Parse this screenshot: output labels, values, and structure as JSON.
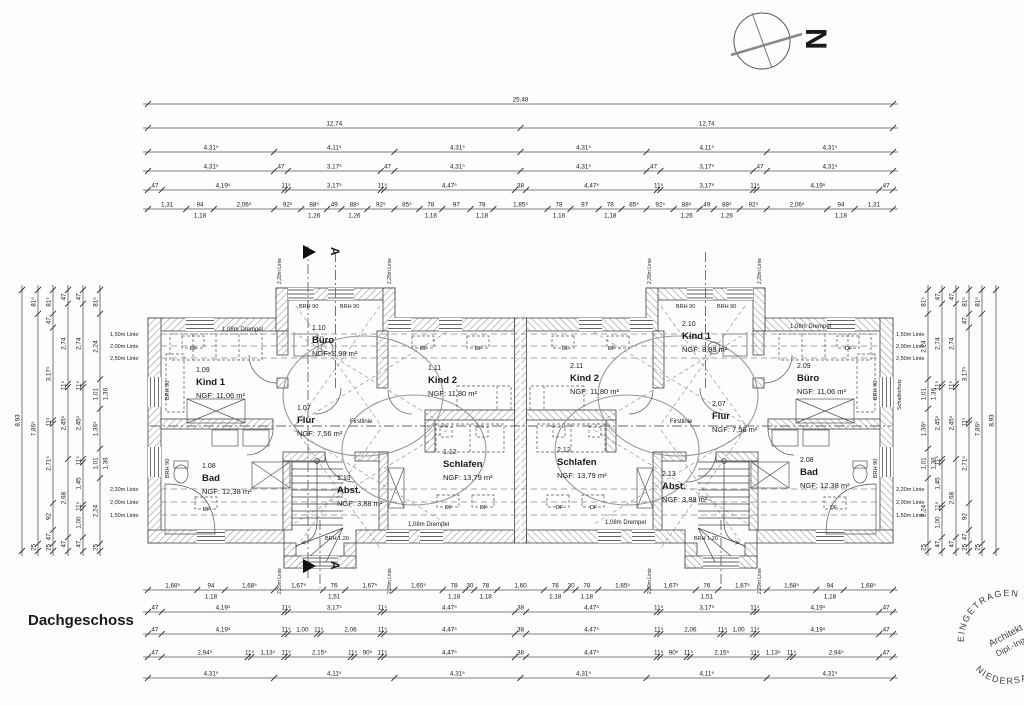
{
  "title": "Dachgeschoss",
  "north": {
    "label": "N"
  },
  "stamp": {
    "arc_top": "EINGETRAGEN IN",
    "arc_bottom": "NIEDERSACHSEN •",
    "center_line1": "Architekt",
    "center_line2": "Dipl.-Ing.",
    "color": "#c75a55"
  },
  "plan": {
    "rooms": [
      {
        "nr": "1.09",
        "name": "Kind 1",
        "area": "NGF: 11,06 m²",
        "x": 196,
        "y": 372
      },
      {
        "nr": "1.10",
        "name": "Büro",
        "area": "NGF: 8,98 m²",
        "x": 312,
        "y": 330
      },
      {
        "nr": "1.11",
        "name": "Kind 2",
        "area": "NGF: 11,80 m²",
        "x": 428,
        "y": 370
      },
      {
        "nr": "1.07",
        "name": "Flur",
        "area": "NGF: 7,56 m²",
        "x": 297,
        "y": 410
      },
      {
        "nr": "1.08",
        "name": "Bad",
        "area": "NGF: 12,38 m²",
        "x": 202,
        "y": 468
      },
      {
        "nr": "1.12",
        "name": "Schlafen",
        "area": "NGF: 13,79 m²",
        "x": 443,
        "y": 454
      },
      {
        "nr": "1.13",
        "name": "Abst.",
        "area": "NGF: 3,88 m²",
        "x": 337,
        "y": 480
      },
      {
        "nr": "2.10",
        "name": "Kind 1",
        "area": "NGF: 8,98 m²",
        "x": 682,
        "y": 326
      },
      {
        "nr": "2.11",
        "name": "Kind 2",
        "area": "NGF: 11,80 m²",
        "x": 570,
        "y": 368
      },
      {
        "nr": "2.09",
        "name": "Büro",
        "area": "NGF: 11,06 m²",
        "x": 797,
        "y": 368
      },
      {
        "nr": "2.07",
        "name": "Flur",
        "area": "NGF: 7,56 m²",
        "x": 712,
        "y": 406
      },
      {
        "nr": "2.12",
        "name": "Schlafen",
        "area": "NGF: 13,79 m²",
        "x": 557,
        "y": 452
      },
      {
        "nr": "2.13",
        "name": "Abst.",
        "area": "NGF: 3,88 m²",
        "x": 662,
        "y": 476
      },
      {
        "nr": "2.08",
        "name": "Bad",
        "area": "NGF: 12,38 m²",
        "x": 800,
        "y": 462
      }
    ],
    "annotations": [
      {
        "t": "1,08m Drempel",
        "x": 222,
        "y": 331,
        "s": 6
      },
      {
        "t": "1,08m Drempel",
        "x": 790,
        "y": 328,
        "s": 6
      },
      {
        "t": "1,08m Drempel",
        "x": 408,
        "y": 526,
        "s": 6
      },
      {
        "t": "1,08m Drempel",
        "x": 605,
        "y": 524,
        "s": 6
      },
      {
        "t": "Firstlinie",
        "x": 350,
        "y": 423,
        "s": 6
      },
      {
        "t": "Firstlinie",
        "x": 670,
        "y": 423,
        "s": 6
      },
      {
        "t": "BRH 90",
        "x": 299,
        "y": 308,
        "s": 5.5
      },
      {
        "t": "BRH 90",
        "x": 340,
        "y": 308,
        "s": 5.5
      },
      {
        "t": "BRH 90",
        "x": 676,
        "y": 308,
        "s": 5.5
      },
      {
        "t": "BRH 90",
        "x": 717,
        "y": 308,
        "s": 5.5
      },
      {
        "t": "BRH 90",
        "x": 169,
        "y": 400,
        "s": 5.5,
        "r": -90
      },
      {
        "t": "BRH 90",
        "x": 169,
        "y": 478,
        "s": 5.5,
        "r": -90
      },
      {
        "t": "BRH 90",
        "x": 877,
        "y": 400,
        "s": 5.5,
        "r": -90
      },
      {
        "t": "BRH 90",
        "x": 877,
        "y": 478,
        "s": 5.5,
        "r": -90
      },
      {
        "t": "Schallschutz",
        "x": 901,
        "y": 410,
        "s": 5.5,
        "r": -90
      },
      {
        "t": "BRH 1,20",
        "x": 325,
        "y": 540,
        "s": 5.5
      },
      {
        "t": "BRH 1,20",
        "x": 694,
        "y": 540,
        "s": 5.5
      },
      {
        "t": "1,50m Linie",
        "x": 110,
        "y": 336,
        "s": 5.5
      },
      {
        "t": "2,00m Linie",
        "x": 110,
        "y": 348,
        "s": 5.5
      },
      {
        "t": "2,50m Linie",
        "x": 110,
        "y": 360,
        "s": 5.5
      },
      {
        "t": "2,20m Linie",
        "x": 110,
        "y": 491,
        "s": 5.5
      },
      {
        "t": "2,00m Linie",
        "x": 110,
        "y": 504,
        "s": 5.5
      },
      {
        "t": "1,50m Linie",
        "x": 110,
        "y": 517,
        "s": 5.5
      },
      {
        "t": "1,50m Linie",
        "x": 896,
        "y": 336,
        "s": 5.5
      },
      {
        "t": "2,00m Linie",
        "x": 896,
        "y": 348,
        "s": 5.5
      },
      {
        "t": "2,50m Linie",
        "x": 896,
        "y": 360,
        "s": 5.5
      },
      {
        "t": "2,20m Linie",
        "x": 896,
        "y": 491,
        "s": 5.5
      },
      {
        "t": "2,00m Linie",
        "x": 896,
        "y": 504,
        "s": 5.5
      },
      {
        "t": "1,50m Linie",
        "x": 896,
        "y": 517,
        "s": 5.5
      },
      {
        "t": "2,29m Linie",
        "x": 281,
        "y": 284,
        "s": 5,
        "r": -90
      },
      {
        "t": "2,29m Linie",
        "x": 391,
        "y": 284,
        "s": 5,
        "r": -90
      },
      {
        "t": "2,29m Linie",
        "x": 651,
        "y": 284,
        "s": 5,
        "r": -90
      },
      {
        "t": "2,29m Linie",
        "x": 761,
        "y": 284,
        "s": 5,
        "r": -90
      },
      {
        "t": "2,29m Linie",
        "x": 281,
        "y": 594,
        "s": 5,
        "r": -90
      },
      {
        "t": "2,29m Linie",
        "x": 391,
        "y": 594,
        "s": 5,
        "r": -90
      },
      {
        "t": "2,29m Linie",
        "x": 651,
        "y": 594,
        "s": 5,
        "r": -90
      },
      {
        "t": "2,29m Linie",
        "x": 761,
        "y": 594,
        "s": 5,
        "r": -90
      },
      {
        "t": "A",
        "x": 331,
        "y": 247,
        "s": 12,
        "b": 1,
        "r": 90
      },
      {
        "t": "A",
        "x": 331,
        "y": 561,
        "s": 12,
        "b": 1,
        "r": 90
      },
      {
        "t": "DF",
        "x": 190,
        "y": 350,
        "s": 5.5
      },
      {
        "t": "DF",
        "x": 420,
        "y": 350,
        "s": 5.5
      },
      {
        "t": "DF",
        "x": 475,
        "y": 350,
        "s": 5.5
      },
      {
        "t": "DF",
        "x": 203,
        "y": 511,
        "s": 5.5
      },
      {
        "t": "DF",
        "x": 445,
        "y": 509,
        "s": 5.5
      },
      {
        "t": "DF",
        "x": 480,
        "y": 509,
        "s": 5.5
      },
      {
        "t": "DF",
        "x": 845,
        "y": 350,
        "s": 5.5
      },
      {
        "t": "DF",
        "x": 608,
        "y": 350,
        "s": 5.5
      },
      {
        "t": "DF",
        "x": 562,
        "y": 350,
        "s": 5.5
      },
      {
        "t": "DF",
        "x": 830,
        "y": 509,
        "s": 5.5
      },
      {
        "t": "DF",
        "x": 590,
        "y": 509,
        "s": 5.5
      },
      {
        "t": "DF",
        "x": 556,
        "y": 509,
        "s": 5.5
      }
    ]
  },
  "dims": {
    "top": {
      "x0": 148,
      "len": 745,
      "rows": [
        {
          "y": 104,
          "segs": [
            "25,48"
          ]
        },
        {
          "y": 128,
          "segs": [
            "12,74",
            "12,74"
          ]
        },
        {
          "y": 152,
          "segs": [
            "4,31⁵",
            "4,11⁵",
            "4,31⁵",
            "4,31⁵",
            "4,11⁵",
            "4,31⁵"
          ]
        },
        {
          "y": 171,
          "segs": [
            "4,31⁵",
            "47",
            "3,17⁵",
            "47",
            "4,31⁵",
            "4,31⁵",
            "47",
            "3,17⁵",
            "47",
            "4,31⁵"
          ]
        },
        {
          "y": 190,
          "segs": [
            "47",
            "4,19⁵",
            "11⁵",
            "3,17⁵",
            "11⁵",
            "4,47⁵",
            "38",
            "4,47⁵",
            "11⁵",
            "3,17⁵",
            "11⁵",
            "4,19⁵",
            "47"
          ]
        },
        {
          "y": 209,
          "segs": [
            "1,31",
            "94|1,18",
            "2,06⁵",
            "92⁵",
            "88⁵|1,26",
            "49",
            "88⁵|1,26",
            "92⁵",
            "85⁵",
            "78|1,18",
            "97",
            "78|1,18",
            "1,85⁵",
            "78|1,18",
            "97",
            "78|1,18",
            "85⁵",
            "92⁵",
            "88⁵|1,26",
            "49",
            "88⁵|1,26",
            "92⁵",
            "2,06⁵",
            "94|1,18",
            "1,31"
          ]
        }
      ]
    },
    "bottom": {
      "x0": 148,
      "len": 745,
      "rows": [
        {
          "y": 590,
          "segs": [
            "1,68⁵",
            "94|1,18",
            "1,68⁵",
            "1,67⁵",
            "76|1,51",
            "1,67⁵",
            "1,65⁵",
            "78|1,18",
            "30",
            "78|1,18",
            "1,60",
            "78|1,18",
            "30",
            "78|1,18",
            "1,65⁵",
            "1,67⁵",
            "76|1,51",
            "1,67⁵",
            "1,68⁵",
            "94|1,18",
            "1,68⁵"
          ]
        },
        {
          "y": 612,
          "segs": [
            "47",
            "4,19⁵",
            "11⁵",
            "3,17⁵",
            "11⁵",
            "4,47⁵",
            "38",
            "4,47⁵",
            "11⁵",
            "3,17⁵",
            "11⁵",
            "4,19⁵",
            "47"
          ]
        },
        {
          "y": 634,
          "segs": [
            "47",
            "4,19⁵",
            "11⁵",
            "1,00",
            "11⁵",
            "2,06",
            "11⁵",
            "4,47⁵",
            "38",
            "4,47⁵",
            "11⁵",
            "2,06",
            "11⁵",
            "1,00",
            "11⁵",
            "4,19⁵",
            "47"
          ]
        },
        {
          "y": 657,
          "segs": [
            "47",
            "2,94⁵",
            "11⁵",
            "1,13⁵",
            "11⁵",
            "2,15⁵",
            "11⁵",
            "90⁵",
            "11⁵",
            "4,47⁵",
            "38",
            "4,47⁵",
            "11⁵",
            "90⁵",
            "11⁵",
            "2,15⁵",
            "11⁵",
            "1,13⁵",
            "11⁵",
            "2,94⁵",
            "47"
          ]
        },
        {
          "y": 678,
          "segs": [
            "4,31⁵",
            "4,11⁵",
            "4,31⁵",
            "4,31⁵",
            "4,11⁵",
            "4,31⁵"
          ]
        }
      ]
    },
    "left": {
      "y0": 290,
      "len": 261,
      "cols": [
        {
          "x": 22,
          "segs": [
            "8,93"
          ]
        },
        {
          "x": 38,
          "segs": [
            "81⁵",
            "7,86⁵",
            "25"
          ]
        },
        {
          "x": 53,
          "segs": [
            "81⁵",
            "47",
            "3,17⁵",
            "11⁵",
            "2,71⁵",
            "92",
            "47",
            "25"
          ]
        },
        {
          "x": 68,
          "segs": [
            "47",
            "2,74",
            "11⁵",
            "2,45⁵",
            "2,68",
            "47"
          ]
        },
        {
          "x": 83,
          "segs": [
            "47",
            "2,74",
            "11⁵",
            "2,45⁵",
            "11⁵",
            "1,45",
            "11⁵",
            "1,00",
            "47"
          ]
        },
        {
          "x": 100,
          "segs": [
            "81⁵",
            "2,24",
            "1,01|1,36",
            "1,36⁵",
            "1,01|1,36",
            "2,24",
            "25"
          ]
        }
      ]
    },
    "right": {
      "y0": 290,
      "len": 261,
      "cols": [
        {
          "x": 928,
          "segs": [
            "81⁵",
            "2,24",
            "1,01|1,36",
            "1,36⁵",
            "1,01|1,36",
            "2,24",
            "25"
          ]
        },
        {
          "x": 942,
          "segs": [
            "47",
            "2,74",
            "11⁵",
            "2,45⁵",
            "11⁵",
            "1,45",
            "11⁵",
            "1,00",
            "47"
          ]
        },
        {
          "x": 956,
          "segs": [
            "47",
            "2,74",
            "11⁵",
            "2,45⁵",
            "2,68",
            "47"
          ]
        },
        {
          "x": 969,
          "segs": [
            "81⁵",
            "47",
            "3,17⁵",
            "11⁵",
            "2,71⁵",
            "92",
            "47",
            "25"
          ]
        },
        {
          "x": 982,
          "segs": [
            "81⁵",
            "7,86⁵",
            "25"
          ]
        },
        {
          "x": 996,
          "segs": [
            "8,93"
          ]
        }
      ]
    }
  }
}
